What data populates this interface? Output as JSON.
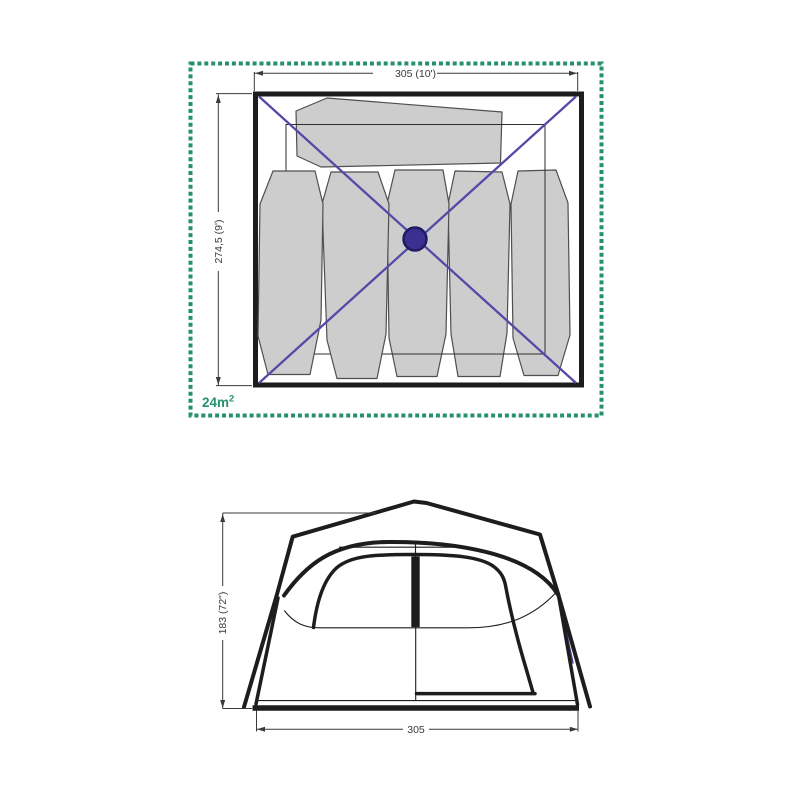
{
  "floor_plan": {
    "width_label": "305 (10')",
    "depth_label": "274,5 (9')",
    "area_value": "24m",
    "area_superscript": "2"
  },
  "front_view": {
    "height_label": "183 (72\")",
    "width_label": "305"
  },
  "colors": {
    "accent_green": "#27916c",
    "line_black": "#1d1d1d",
    "pad_fill": "#cdcdcd",
    "pad_stroke": "#4f4f4f",
    "guy_line_purple": "#5349a7",
    "hub_fill": "#3b2f8f",
    "hub_stroke": "#201a60",
    "dim_gray": "#3a3a3a",
    "blue_trim": "#3c3c8f"
  }
}
